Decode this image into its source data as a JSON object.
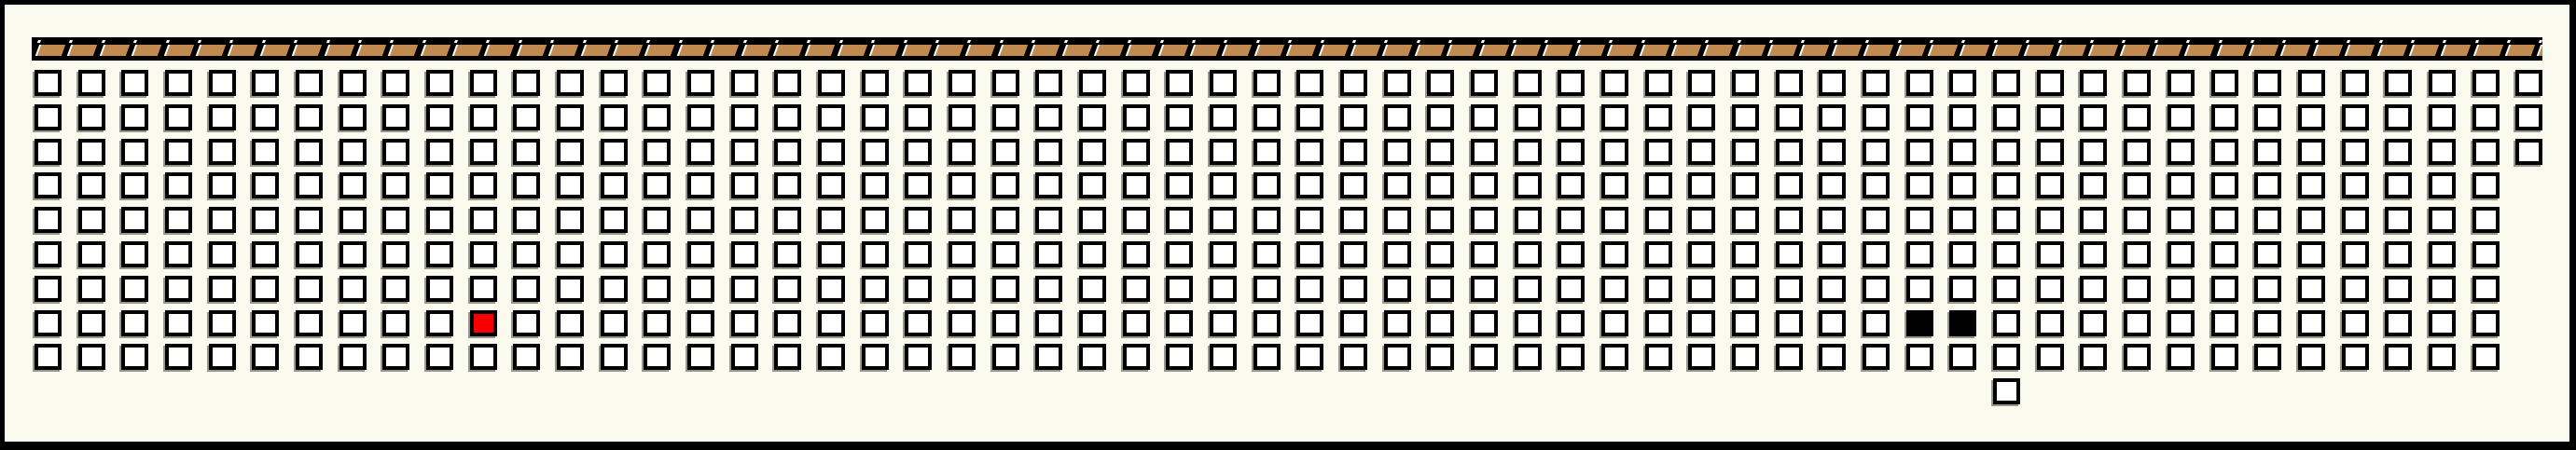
{
  "page": {
    "background_color": "#FBFAEF",
    "frame_color": "#000000"
  },
  "top_strip": {
    "band_color": "#000000",
    "tile_color": "#C08A50",
    "tile_highlight_color": "#FFFFFF",
    "tile_count": 79
  },
  "grid": {
    "cell_fill_color": "#FFFFFF",
    "cell_border_color": "#000000",
    "cell_shadow_color": "#97978D",
    "rows": [
      {
        "row": 0,
        "cols": 58
      },
      {
        "row": 1,
        "cols": 58
      },
      {
        "row": 2,
        "cols": 58
      },
      {
        "row": 3,
        "cols": 57
      },
      {
        "row": 4,
        "cols": 57
      },
      {
        "row": 5,
        "cols": 57
      },
      {
        "row": 6,
        "cols": 57
      },
      {
        "row": 7,
        "cols": 57
      },
      {
        "row": 8,
        "cols": 57
      }
    ],
    "extra_cells": [
      {
        "row": 9,
        "col": 45,
        "fill": "#FFFFFF",
        "name": "lone-cell"
      }
    ],
    "highlighted_cells": [
      {
        "row": 7,
        "col": 10,
        "fill": "#F90000",
        "name": "red-cell"
      },
      {
        "row": 7,
        "col": 43,
        "fill": "#000000",
        "name": "black-cell-1"
      },
      {
        "row": 7,
        "col": 44,
        "fill": "#000000",
        "name": "black-cell-2"
      }
    ]
  }
}
